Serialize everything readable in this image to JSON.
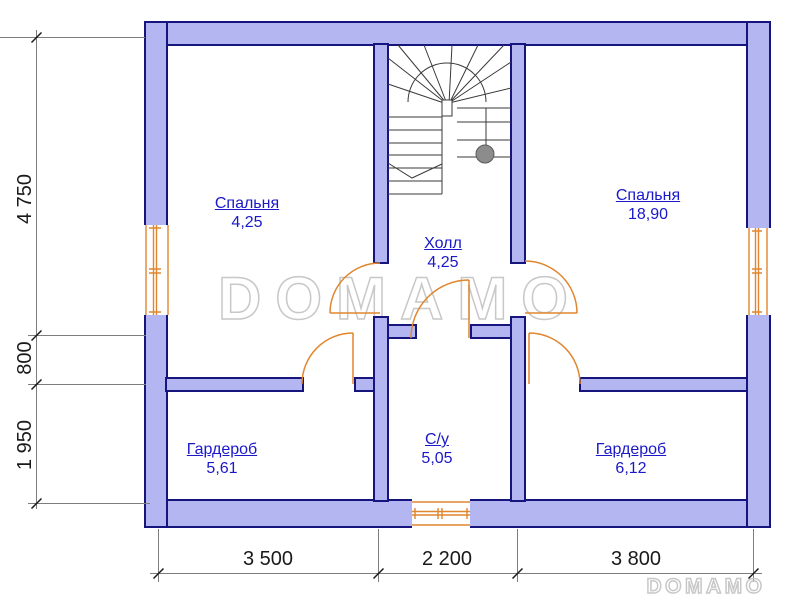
{
  "plan": {
    "rooms": [
      {
        "id": "bedroom-left",
        "name": "Спальня",
        "area": "4,25"
      },
      {
        "id": "bedroom-right",
        "name": "Спальня",
        "area": "18,90"
      },
      {
        "id": "hall",
        "name": "Холл",
        "area": "4,25"
      },
      {
        "id": "wardrobe-left",
        "name": "Гардероб",
        "area": "5,61"
      },
      {
        "id": "bathroom",
        "name": "С/у",
        "area": "5,05"
      },
      {
        "id": "wardrobe-right",
        "name": "Гардероб",
        "area": "6,12"
      }
    ],
    "dimensions_left": [
      {
        "label": "4 750"
      },
      {
        "label": "800"
      },
      {
        "label": "1 950"
      }
    ],
    "dimensions_bottom": [
      {
        "label": "3 500"
      },
      {
        "label": "2 200"
      },
      {
        "label": "3 800"
      }
    ],
    "watermark_large": "DOMAMO",
    "watermark_small": "DOMAMO"
  },
  "colors": {
    "wall_fill": "#b4b6f2",
    "wall_outline": "#15157d",
    "door": "#e0862e",
    "label": "#1a18c8",
    "dim_text": "#1a1a1a",
    "dim_line": "#7d7d7d",
    "stair_line": "#3a3a3a",
    "newel_circle": "#8c8c8c",
    "watermark": "#c8c8c8"
  }
}
